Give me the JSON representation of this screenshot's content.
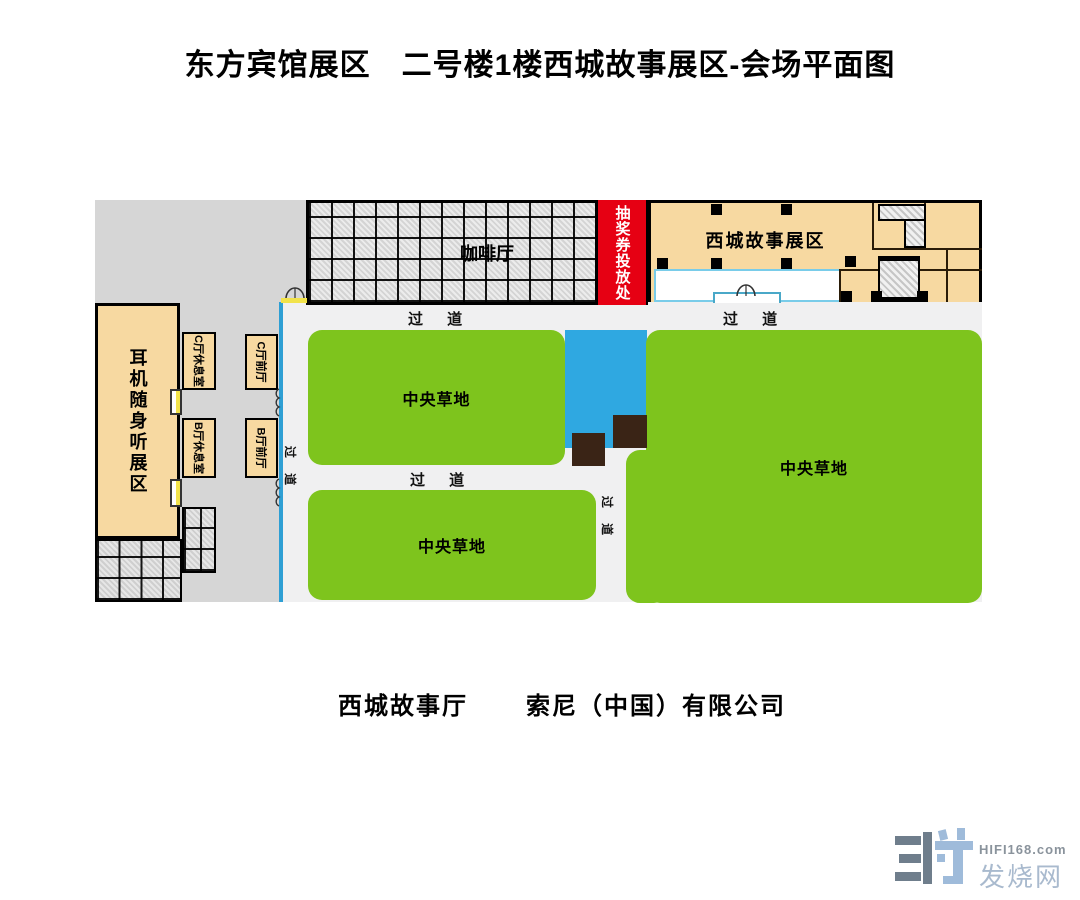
{
  "title": "东方宾馆展区　二号楼1楼西城故事展区-会场平面图",
  "plan": {
    "coffee_hall": "咖啡厅",
    "lottery_booth": "抽奖券投放处",
    "story_exhibit": "西城故事展区",
    "headphone_exhibit": "耳机随身听展区",
    "lounge_c": "C厅休息室",
    "lounge_b": "B厅休息室",
    "foyer_c": "C厅前厅",
    "foyer_b": "B厅前厅",
    "lawn": "中央草地",
    "aisle": "过 道",
    "aisle_vertical": "过 道"
  },
  "caption": {
    "hall": "西城故事厅",
    "company": "索尼（中国）有限公司"
  },
  "logo": {
    "site": "HIFI168.com",
    "name": "发烧网"
  },
  "colors": {
    "lawn_green": "#7EC41D",
    "pool_blue": "#2FA8E1",
    "booth_red": "#E60013",
    "room_tan": "#F7D9A1",
    "corridor_line_blue": "#2E9FD4",
    "planter_brown": "#3A2416",
    "floor_gray": "#D6D6D6"
  }
}
